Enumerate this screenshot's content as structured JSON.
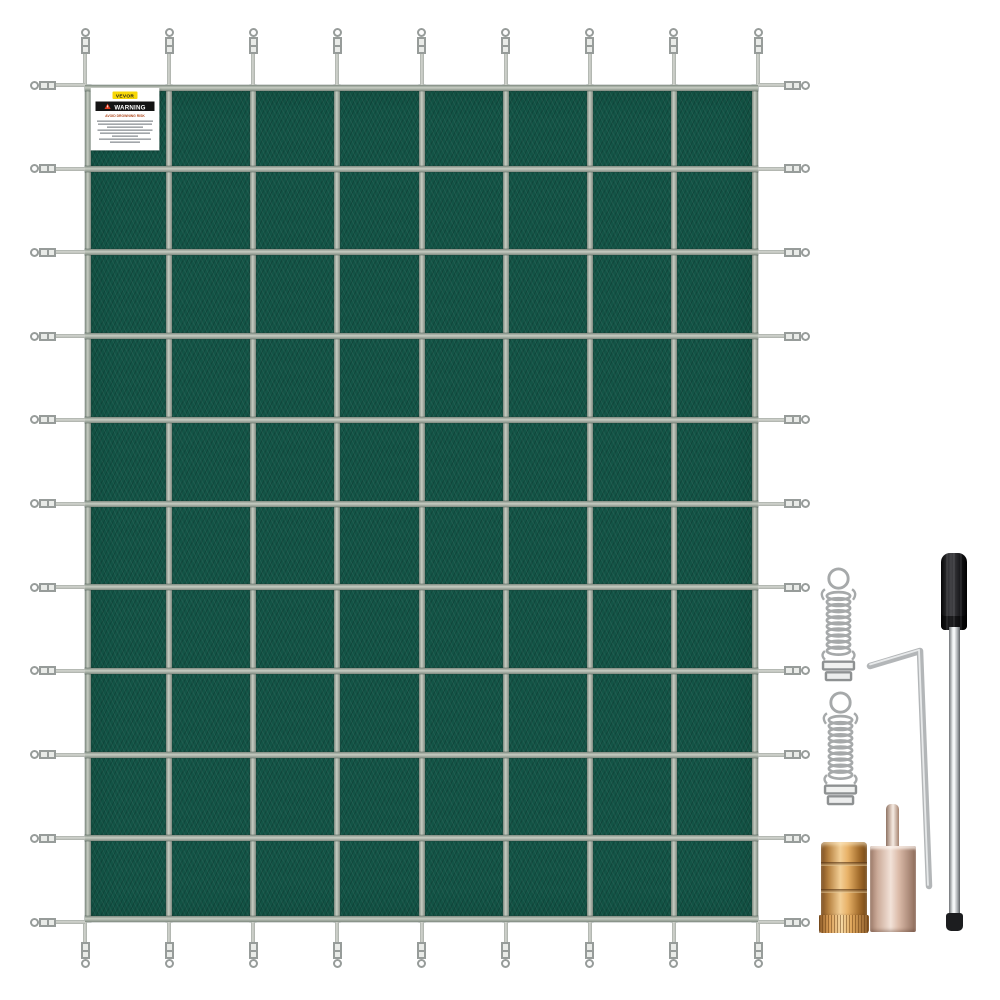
{
  "scene": {
    "description": "Green mesh rectangular pool safety cover with silver strap grid, perimeter buckles and installation hardware kit",
    "background": "#ffffff"
  },
  "cover": {
    "grid": {
      "columns": 8,
      "rows": 10
    },
    "fabric_color": "#135446",
    "fabric_texture_color": "#0e4337",
    "strap_light": "#c6ccc2",
    "strap_dark": "#7f8a80",
    "strap_ends": {
      "top": 9,
      "bottom": 9,
      "left": 11,
      "right": 11
    },
    "buckle_fill": "#e9ebe8",
    "metal_dark": "#979c9a"
  },
  "warning_label": {
    "brand": "VEVOR",
    "brand_bg": "#f7d707",
    "brand_text_color": "#1c1c1c",
    "title": "WARNING",
    "title_bar_bg": "#141414",
    "title_color": "#ffffff",
    "warning_icon": "triangle-exclamation-icon",
    "warning_icon_color": "#e03c1f",
    "subtitle": "AVOID DROWNING RISK",
    "subtitle_color": "#b04a1e",
    "fine_print_line_widths": [
      56,
      54,
      36,
      55,
      50,
      26,
      52,
      30
    ],
    "fine_print_color": "#8b9196"
  },
  "hardware": {
    "metal_color": "#a6a9aa",
    "metal_dark": "#8e9192",
    "items": [
      {
        "id": "spring-top",
        "name": "tension-spring"
      },
      {
        "id": "spring-bottom",
        "name": "tension-spring"
      },
      {
        "id": "hex-key",
        "name": "hex-key-tool"
      },
      {
        "id": "brass-anchor",
        "name": "brass-wedge-anchor"
      },
      {
        "id": "tamping-tool",
        "name": "anchor-tamping-tool"
      },
      {
        "id": "installation-rod",
        "name": "installation-rod"
      }
    ],
    "brass_colors": [
      "#7d4e1f",
      "#f3cf96",
      "#744716"
    ],
    "rose_colors": [
      "#9c7a69",
      "#f2e2d8",
      "#8e6c5b"
    ],
    "rod_handle_color": "#0c0c0e",
    "rod_shaft_colors": [
      "#6f7376",
      "#f9fbfc",
      "#5d6164"
    ]
  }
}
